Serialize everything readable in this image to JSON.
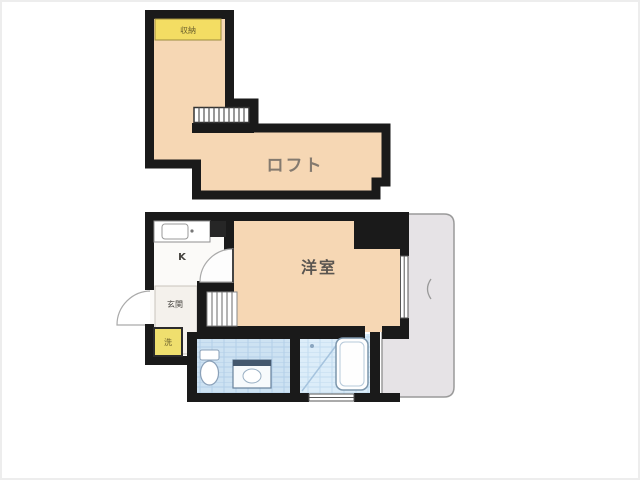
{
  "floorplan": {
    "type": "apartment-floor-plan",
    "loft": {
      "label": "ロフト",
      "storage_label": "収納"
    },
    "main_floor": {
      "western_room_label": "洋室",
      "kitchen_label": "K",
      "entrance_label": "玄関",
      "washer_label": "洗"
    },
    "colors": {
      "room_fill": "#f6d7b4",
      "highlight_yellow": "#f3dd63",
      "wall": "#1a1a1a",
      "balcony_fill": "#e6e3e6",
      "bath_tile": "#cde2f2",
      "bath_tile_light": "#dcedf9",
      "background": "#ffffff"
    }
  }
}
